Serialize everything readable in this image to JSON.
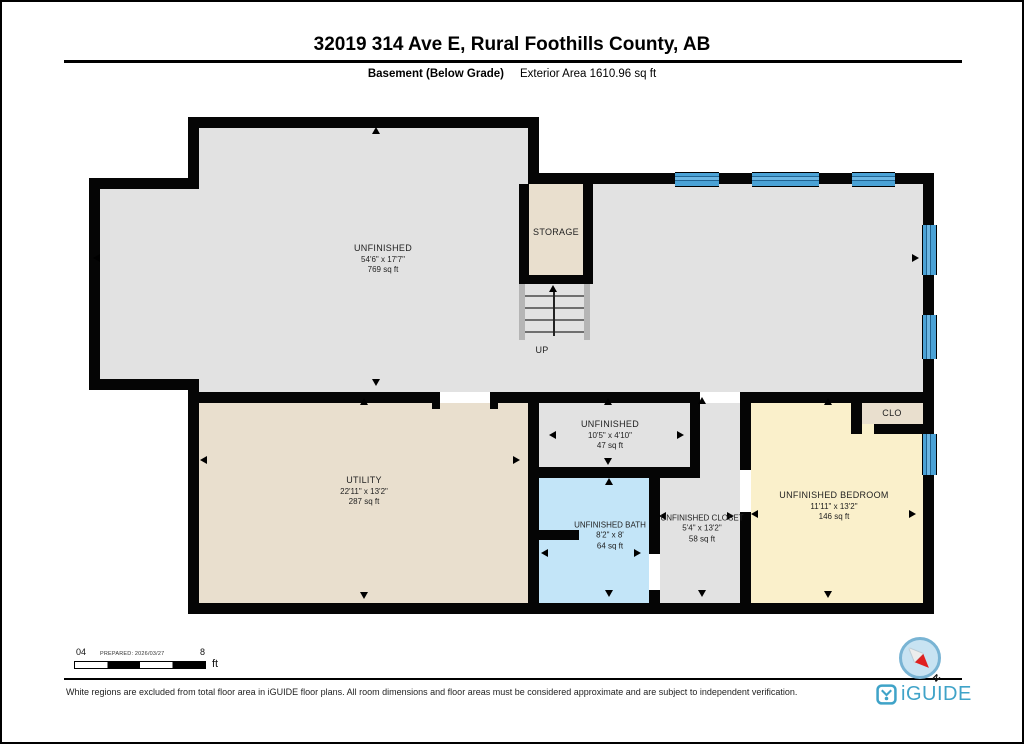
{
  "header": {
    "title": "32019 314 Ave E, Rural Foothills County, AB",
    "floor_label": "Basement (Below Grade)",
    "area_label": "Exterior Area 1610.96 sq ft"
  },
  "rooms": {
    "unfinished_main": {
      "name": "UNFINISHED",
      "dims": "54'6\" x 17'7\"",
      "area": "769 sq ft"
    },
    "storage": {
      "name": "STORAGE"
    },
    "stairs": {
      "label": "UP"
    },
    "utility": {
      "name": "UTILITY",
      "dims": "22'11\" x 13'2\"",
      "area": "287 sq ft"
    },
    "unfinished_small": {
      "name": "UNFINISHED",
      "dims": "10'5\" x 4'10\"",
      "area": "47 sq ft"
    },
    "bath": {
      "name": "UNFINISHED BATH",
      "dims": "8'2\" x 8'",
      "area": "64 sq ft"
    },
    "closet": {
      "name": "UNFINISHED CLOSET",
      "dims": "5'4\" x 13'2\"",
      "area": "58 sq ft"
    },
    "bedroom": {
      "name": "UNFINISHED BEDROOM",
      "dims": "11'11\" x 13'2\"",
      "area": "146 sq ft"
    },
    "clo": {
      "name": "CLO"
    }
  },
  "scale_bar": {
    "left_labels": "04",
    "prepared": "PREPARED: 2026/03/27",
    "right_label": "8",
    "unit": "ft"
  },
  "compass": {
    "north_label": "N"
  },
  "footer": {
    "disclaimer": "White regions are excluded from total floor area in iGUIDE floor plans. All room dimensions and floor areas must be considered approximate and are subject to independent verification.",
    "brand": "iGUIDE"
  },
  "colors": {
    "wall": "#050505",
    "room_gray": "#e2e2e2",
    "room_beige": "#e9dfce",
    "room_yellow": "#faf0cb",
    "bath_blue": "#c3e5f8",
    "window_blue": "#4aa2d6",
    "brand_blue": "#3fa3c8",
    "compass_red": "#e02020"
  }
}
